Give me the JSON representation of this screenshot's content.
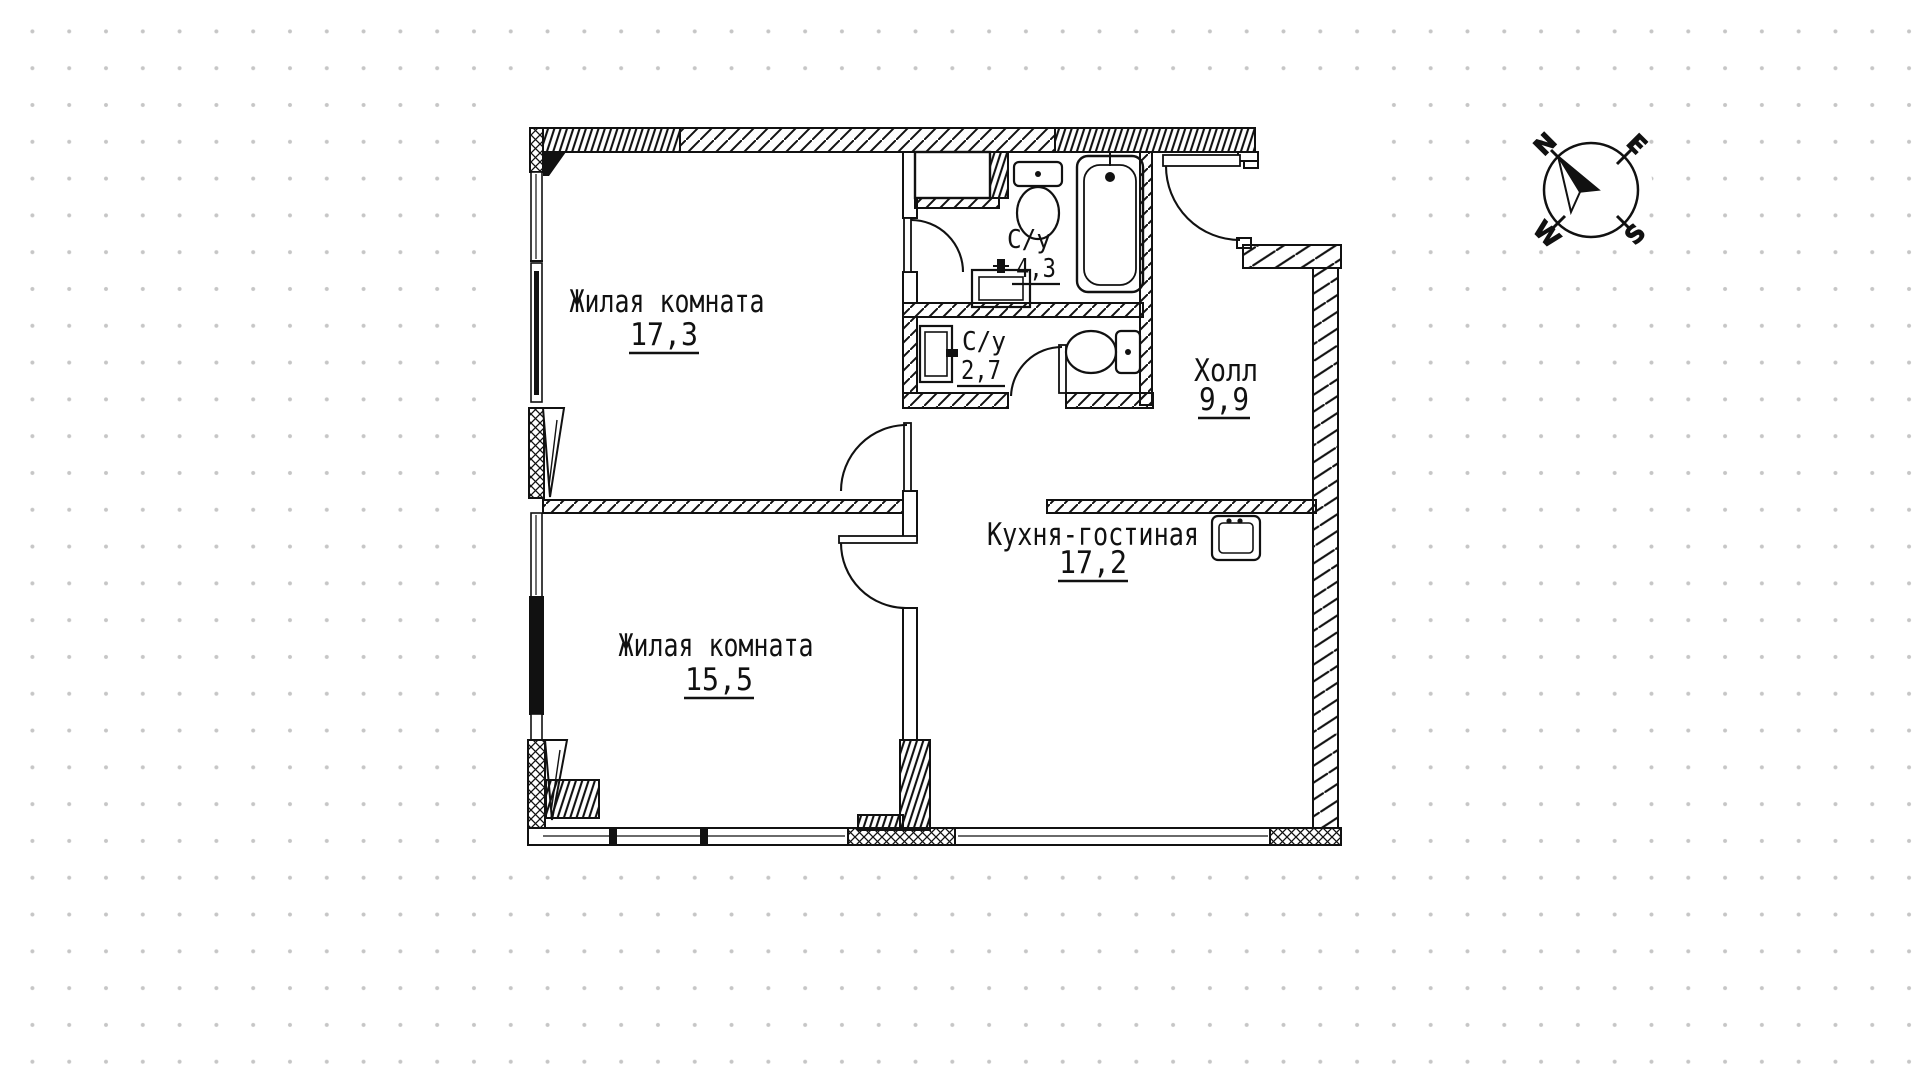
{
  "document": {
    "type": "apartment-floor-plan"
  },
  "rooms": [
    {
      "id": "living-room-1",
      "label": "Жилая комната",
      "area": "17,3"
    },
    {
      "id": "living-room-2",
      "label": "Жилая комната",
      "area": "15,5"
    },
    {
      "id": "kitchen-living",
      "label": "Кухня-гостиная",
      "area": "17,2"
    },
    {
      "id": "hall",
      "label": "Холл",
      "area": "9,9"
    },
    {
      "id": "bathroom-1",
      "label": "С/у",
      "area": "4,3"
    },
    {
      "id": "bathroom-2",
      "label": "С/у",
      "area": "2,7"
    }
  ],
  "compass": {
    "north": "N",
    "east": "E",
    "south": "S",
    "west": "W"
  },
  "icons": {
    "fixtures": [
      "toilet-icon",
      "bathtub-icon",
      "sink-icon",
      "kitchen-sink-icon",
      "compass-rose-icon",
      "door-swing-icon"
    ]
  },
  "colors": {
    "line": "#111111",
    "dots": "#c6c6c6",
    "background": "#ffffff"
  }
}
